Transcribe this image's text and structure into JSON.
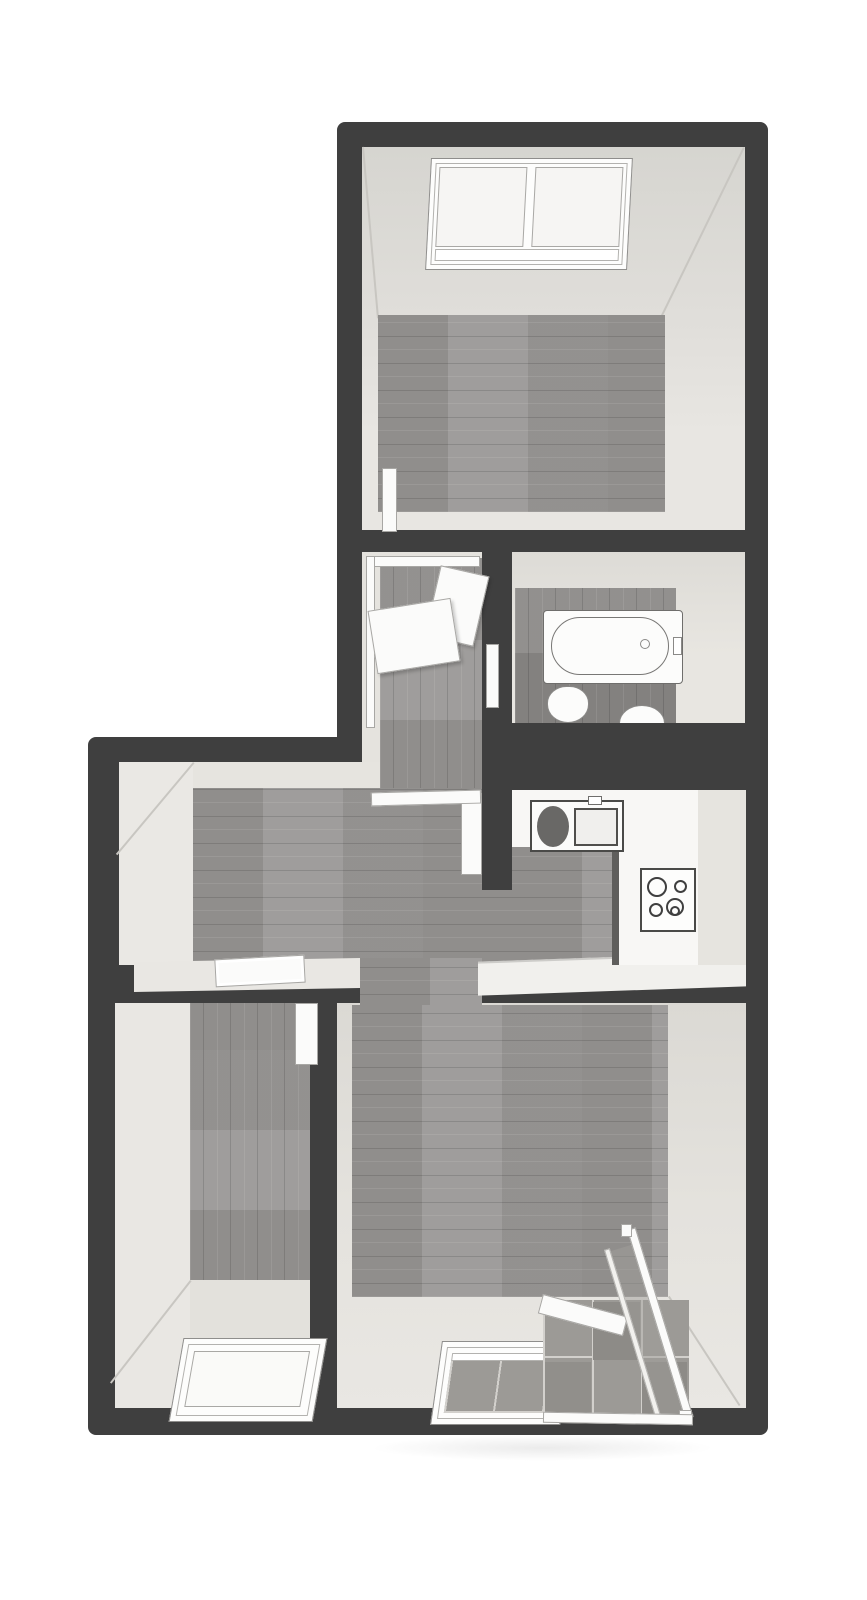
{
  "figure": {
    "type": "floor-plan-3d-top-view",
    "description": "Dollhouse-style rendered floor plan of an attic apartment, viewed from above. Dark grey walls, grey wood-plank flooring, beige sloped-ceiling faces, white fixtures. No text labels or dimensions are shown.",
    "background_color": "#ffffff"
  },
  "palette": {
    "wall": "#3f3f3f",
    "wall_face_beige": "#e2e0db",
    "wood_floor": "#989694",
    "wood_floor_dark": "#8a8886",
    "balcony_tile": "#9c9a96",
    "fixture_white": "#fbfbfa",
    "window_pane": "#f6f5f3"
  },
  "rooms": [
    {
      "id": "bedroom-top",
      "name": "Top attic room with roof window",
      "floor": "wood planks (horizontal)"
    },
    {
      "id": "stair-landing",
      "name": "Stairwell landing with railing panels",
      "floor": "wood planks (vertical)"
    },
    {
      "id": "bathroom",
      "name": "Bathroom with bathtub and two toilets",
      "floor": "dark wood planks (vertical)"
    },
    {
      "id": "kitchen",
      "name": "Kitchen with L-shaped counter, sink and cooktop",
      "floor": "wood planks (horizontal)"
    },
    {
      "id": "hallway",
      "name": "Central hallway",
      "floor": "wood planks (horizontal)"
    },
    {
      "id": "bedroom-left",
      "name": "Bottom-left attic room with roof window",
      "floor": "wood planks (vertical)"
    },
    {
      "id": "living-room",
      "name": "Living room with roof window and glass-railed loggia",
      "floor": "wood planks (horizontal)"
    }
  ],
  "fixtures": [
    {
      "id": "roof-window-top",
      "name": "Double roof window (top room)"
    },
    {
      "id": "stair-railing",
      "name": "Stair railing with white panels"
    },
    {
      "id": "bathtub",
      "name": "Bathtub with faucet and drain"
    },
    {
      "id": "toilet-1",
      "name": "Toilet"
    },
    {
      "id": "toilet-2",
      "name": "Toilet / bidet (against wall)"
    },
    {
      "id": "kitchen-sink",
      "name": "Kitchen sink with drainer and faucet"
    },
    {
      "id": "cooktop",
      "name": "Four-burner cooktop"
    },
    {
      "id": "roof-window-left",
      "name": "Roof window (bottom-left room)"
    },
    {
      "id": "living-roof-window",
      "name": "Roof window onto loggia (living room)"
    },
    {
      "id": "loggia",
      "name": "Tiled loggia with glass balustrade"
    }
  ],
  "doors": [
    {
      "id": "door-bedroom-top",
      "name": "Door, top room to stair landing",
      "state": "open"
    },
    {
      "id": "door-bathroom",
      "name": "Door, landing to bathroom",
      "state": "open"
    },
    {
      "id": "door-kitchen",
      "name": "Door, hallway to kitchen",
      "state": "open"
    },
    {
      "id": "door-bedroom-left",
      "name": "Door, hallway to bottom-left room",
      "state": "open"
    },
    {
      "id": "opening-hall-landing",
      "name": "Opening with threshold, hallway to landing",
      "state": "open"
    },
    {
      "id": "opening-hall-bedroom-left",
      "name": "Door opening with frame, hallway to bottom-left room",
      "state": "open"
    }
  ]
}
